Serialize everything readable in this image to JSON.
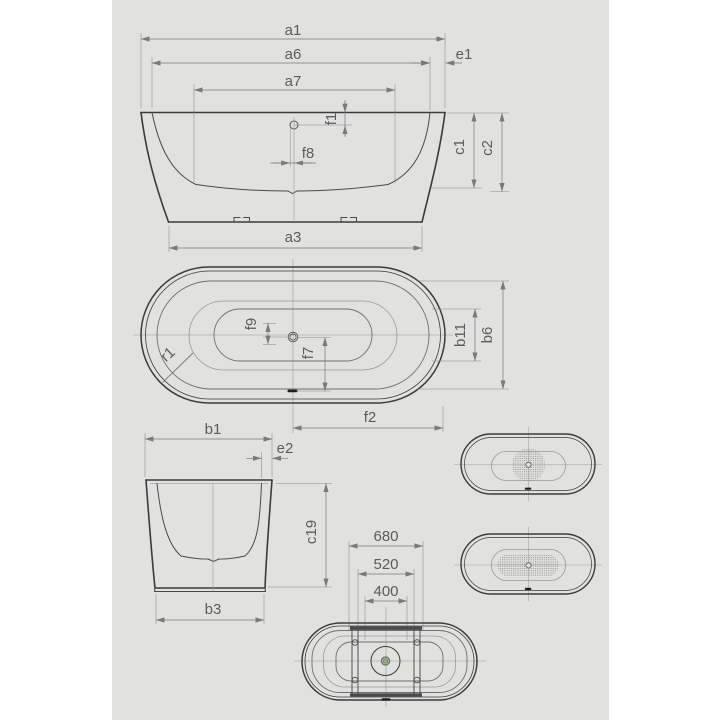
{
  "drawing": {
    "colors": {
      "sheet_background": "#e1e1df",
      "page_background": "#ffffff",
      "outline": "#3b3b3b",
      "dimension": "#7a7a7a",
      "label": "#5c5c5c",
      "drain_dot": "#8fae77"
    },
    "side_view": {
      "labels": {
        "a1": "a1",
        "a6": "a6",
        "a7": "a7",
        "e1": "e1",
        "f1": "f1",
        "f8": "f8",
        "c1": "c1",
        "c2": "c2",
        "a3": "a3"
      }
    },
    "plan_view": {
      "labels": {
        "f9": "f9",
        "f7": "f7",
        "r1": "r1",
        "b11": "b11",
        "b6": "b6",
        "f2": "f2"
      }
    },
    "end_view": {
      "labels": {
        "b1": "b1",
        "e2": "e2",
        "c19": "c19",
        "b3": "b3"
      }
    },
    "bottom_view": {
      "labels": {
        "width_outer": "680",
        "width_mid": "520",
        "width_inner": "400"
      }
    }
  }
}
